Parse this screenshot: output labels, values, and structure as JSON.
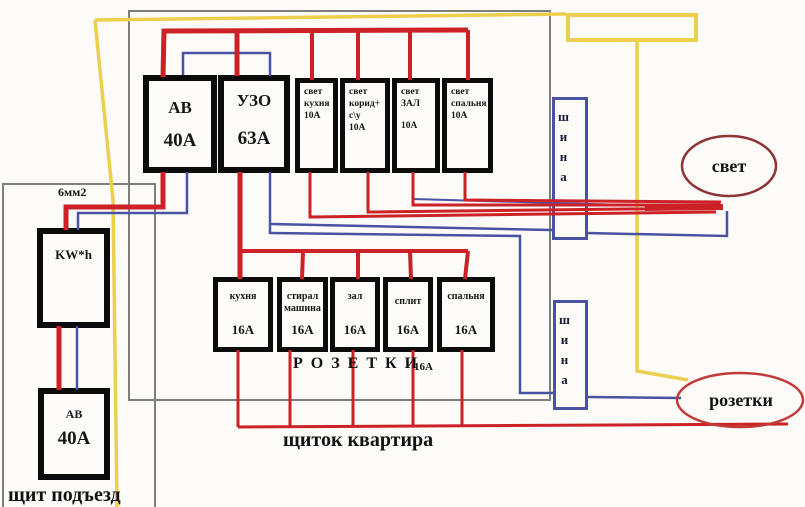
{
  "colors": {
    "phase_red": "#cb2127",
    "neutral_blue": "#4a52a3",
    "ground_yellow": "#eccf4e",
    "light_ellipse_stroke": "#8e3437",
    "sockets_ellipse_stroke": "#c13a38",
    "box_black": "#0b0b0b",
    "enclosure_gray": "#7e7e7e"
  },
  "apartment_panel": {
    "caption": "щиток квартира",
    "main_breaker": {
      "name": "АВ",
      "rating": "40А"
    },
    "rcd": {
      "name": "УЗО",
      "rating": "63А"
    },
    "light_breakers": [
      {
        "lines": [
          "свет",
          "кухня",
          "10А"
        ]
      },
      {
        "lines": [
          "свет",
          "корид+",
          "с\\у",
          "10А"
        ]
      },
      {
        "lines": [
          "свет",
          "ЗАЛ",
          "10А"
        ]
      },
      {
        "lines": [
          "свет",
          "спальня",
          "10А"
        ]
      }
    ],
    "socket_breakers": [
      {
        "name1": "кухня",
        "name2": "",
        "rating": "16А"
      },
      {
        "name1": "стирал",
        "name2": "машина",
        "rating": "16А"
      },
      {
        "name1": "зал",
        "name2": "",
        "rating": "16А"
      },
      {
        "name1": "сплит",
        "name2": "",
        "rating": "16А"
      },
      {
        "name1": "спальня",
        "name2": "",
        "rating": "16А"
      }
    ],
    "sockets_group_label": "Р О З Е Т К И",
    "sockets_group_rating": "16А"
  },
  "entrance_panel": {
    "caption": "щит подъезд",
    "meter_label": "KW*h",
    "breaker": {
      "name": "АВ",
      "rating": "40А"
    },
    "cable_label": "6мм2"
  },
  "buses": {
    "light_bus_label": "шина",
    "socket_bus_label": "шина"
  },
  "loads": {
    "light": "свет",
    "sockets": "розетки"
  }
}
